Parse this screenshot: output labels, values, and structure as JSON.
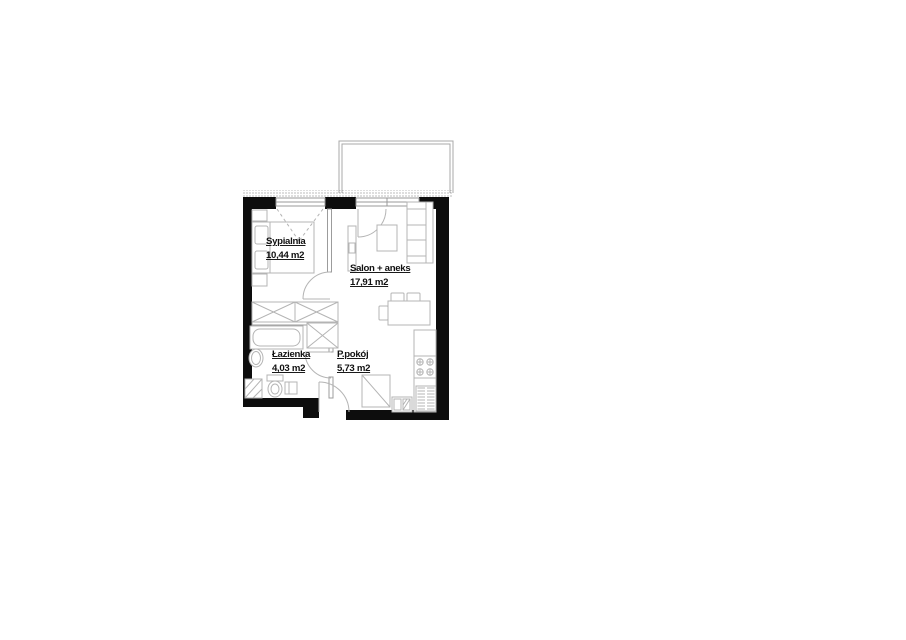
{
  "floor_plan": {
    "rooms": [
      {
        "name": "Sypialnia",
        "area": "10,44 m2"
      },
      {
        "name": "Salon + aneks",
        "area": "17,91 m2"
      },
      {
        "name": "Łazienka",
        "area": "4,03 m2"
      },
      {
        "name": "P.pokój",
        "area": "5,73 m2"
      }
    ],
    "colors": {
      "wall": "#0d0d0d",
      "partition": "#9c9c9c",
      "furniture": "#b4b4b4",
      "balcony": "#a8a8a8",
      "text": "#111111"
    }
  }
}
